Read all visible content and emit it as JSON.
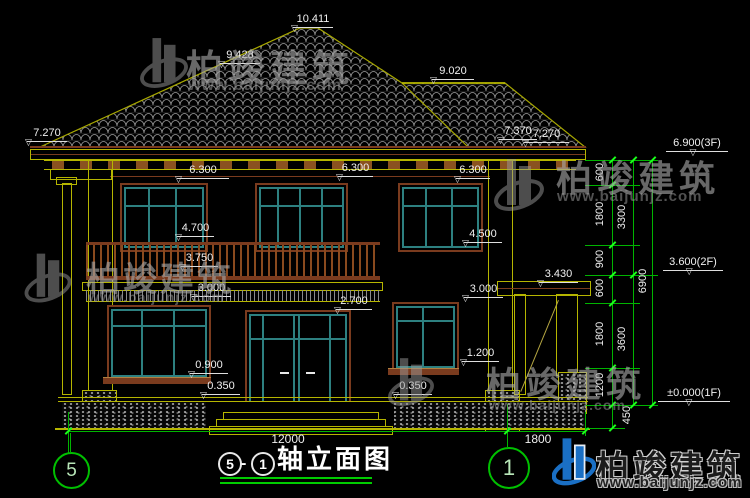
{
  "watermark": {
    "brand": "柏竣建筑",
    "url": "www.baijunjz.com"
  },
  "title": {
    "axis_start": "5",
    "separator": "-",
    "axis_end": "1",
    "text": "轴立面图"
  },
  "axes": {
    "left_bubble": "5",
    "right_bubble": "1"
  },
  "levels": [
    "10.411",
    "9.428",
    "9.020",
    "7.270",
    "7.370",
    "7.270",
    "6.300",
    "6.300",
    "6.300",
    "4.700",
    "4.500",
    "3.750",
    "3.000",
    "2.700",
    "3.430",
    "3.000",
    "1.200",
    "0.900",
    "0.350",
    "0.350",
    "6.900(3F)",
    "3.600(2F)",
    "±0.000(1F)"
  ],
  "dims": {
    "right_chain": [
      "600",
      "1800",
      "900",
      "600",
      "1800",
      "1200",
      "450"
    ],
    "right_subtotals": [
      "3300",
      "3600"
    ],
    "right_total": "6900",
    "bottom_widths": [
      "12000",
      "1800"
    ]
  }
}
